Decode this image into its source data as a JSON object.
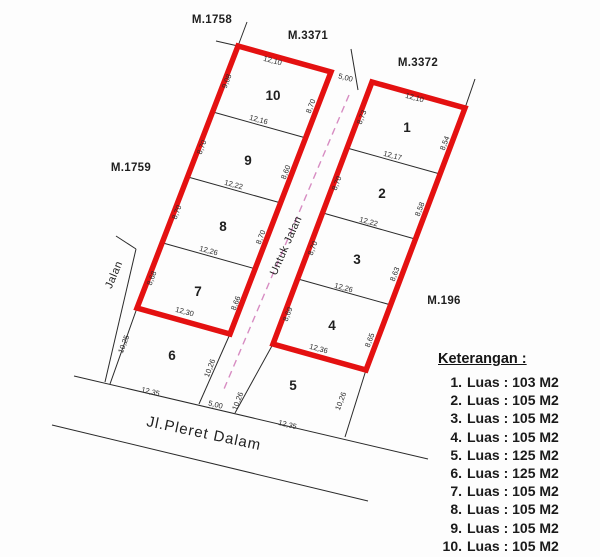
{
  "markers": {
    "m1758": "M.1758",
    "m3371": "M.3371",
    "m3372": "M.3372",
    "m1759": "M.1759",
    "m196": "M.196"
  },
  "roads": {
    "left_strip": "Jalan",
    "center_strip": "Untuk Jalan",
    "bottom_road": "Jl.Pleret Dalam"
  },
  "plots": [
    {
      "no": "1"
    },
    {
      "no": "2"
    },
    {
      "no": "3"
    },
    {
      "no": "4"
    },
    {
      "no": "5"
    },
    {
      "no": "6"
    },
    {
      "no": "7"
    },
    {
      "no": "8"
    },
    {
      "no": "9"
    },
    {
      "no": "10"
    }
  ],
  "dims": {
    "p10_top": "12,10",
    "p10_left": "9,08",
    "p10_right": "8,70",
    "d10_9": "12,16",
    "p9_left": "8,70",
    "p9_right": "8,60",
    "d9_8": "12,22",
    "p8_left": "8,70",
    "p8_right": "8,70",
    "d8_7": "12,26",
    "p7_left": "8,68",
    "p7_right": "8,66",
    "p7_bottom": "12,30",
    "p6_left": "10,25",
    "p6_right": "10,26",
    "p6_bottom": "12,35",
    "p1_top": "12,10",
    "p1_left": "8,73",
    "p1_right": "8,54",
    "d1_2": "12,17",
    "p2_left": "8,70",
    "p2_right": "8,58",
    "d2_3": "12,22",
    "p3_left": "8,70",
    "p3_right": "8,63",
    "d3_4": "12,26",
    "p4_left": "8,69",
    "p4_right": "8,65",
    "p4_bottom": "12,36",
    "p5_left": "10,26",
    "p5_right": "10,26",
    "p5_bottom": "12,35",
    "gap_top": "5,00",
    "gap_bottom": "5,00"
  },
  "legend": {
    "title": "Keterangan :",
    "items": [
      {
        "num": "1.",
        "area": "Luas : 103 M2"
      },
      {
        "num": "2.",
        "area": "Luas : 105 M2"
      },
      {
        "num": "3.",
        "area": "Luas : 105 M2"
      },
      {
        "num": "4.",
        "area": "Luas : 105 M2"
      },
      {
        "num": "5.",
        "area": "Luas : 125 M2"
      },
      {
        "num": "6.",
        "area": "Luas : 125 M2"
      },
      {
        "num": "7.",
        "area": "Luas : 105 M2"
      },
      {
        "num": "8.",
        "area": "Luas : 105 M2"
      },
      {
        "num": "9.",
        "area": "Luas : 105 M2"
      },
      {
        "num": "10.",
        "area": "Luas : 105 M2"
      }
    ]
  },
  "colors": {
    "boundary_red": "#e41111",
    "centerline_pink": "#d78cc2",
    "line_black": "#2a2a2a"
  }
}
